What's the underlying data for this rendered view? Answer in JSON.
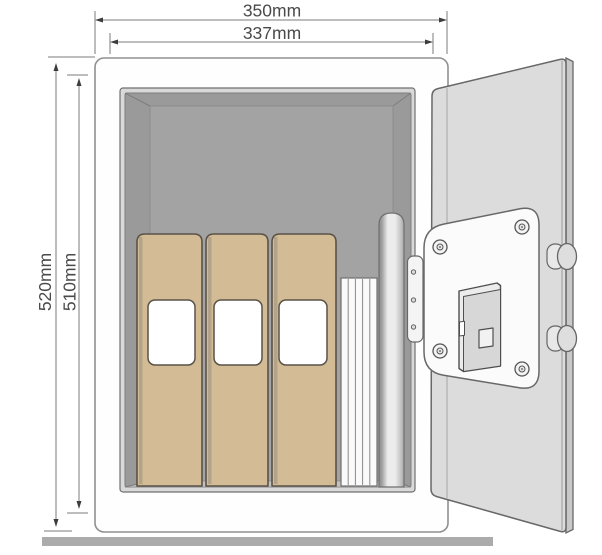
{
  "diagram": {
    "subject": "Safe with open door showing interior with binders, stacked documents and a document tube",
    "dimension_labels": {
      "outer_width": "350mm",
      "inner_width": "337mm",
      "outer_height": "520mm",
      "inner_height": "510mm"
    },
    "colors": {
      "outline": "#686868",
      "dimension_line": "#7b7b7b",
      "dimension_arrow": "#3d3d3d",
      "dimension_text": "#4a4a4a",
      "body": "#fefefe",
      "door": "#dcdcdc",
      "interior_back_wall": "#a3a3a3",
      "interior_side_wall": "#9a9a9a",
      "interior_lip": "#d9d9d9",
      "binder": "#d2bb95",
      "binder_outline": "#5a5248",
      "label_window": "#ffffff",
      "lock_plate": "#fbfbfb",
      "floor_bar": "#ababab"
    },
    "contents": {
      "binders": 3,
      "document_stack_sheets": 5,
      "document_tubes": 1
    }
  }
}
